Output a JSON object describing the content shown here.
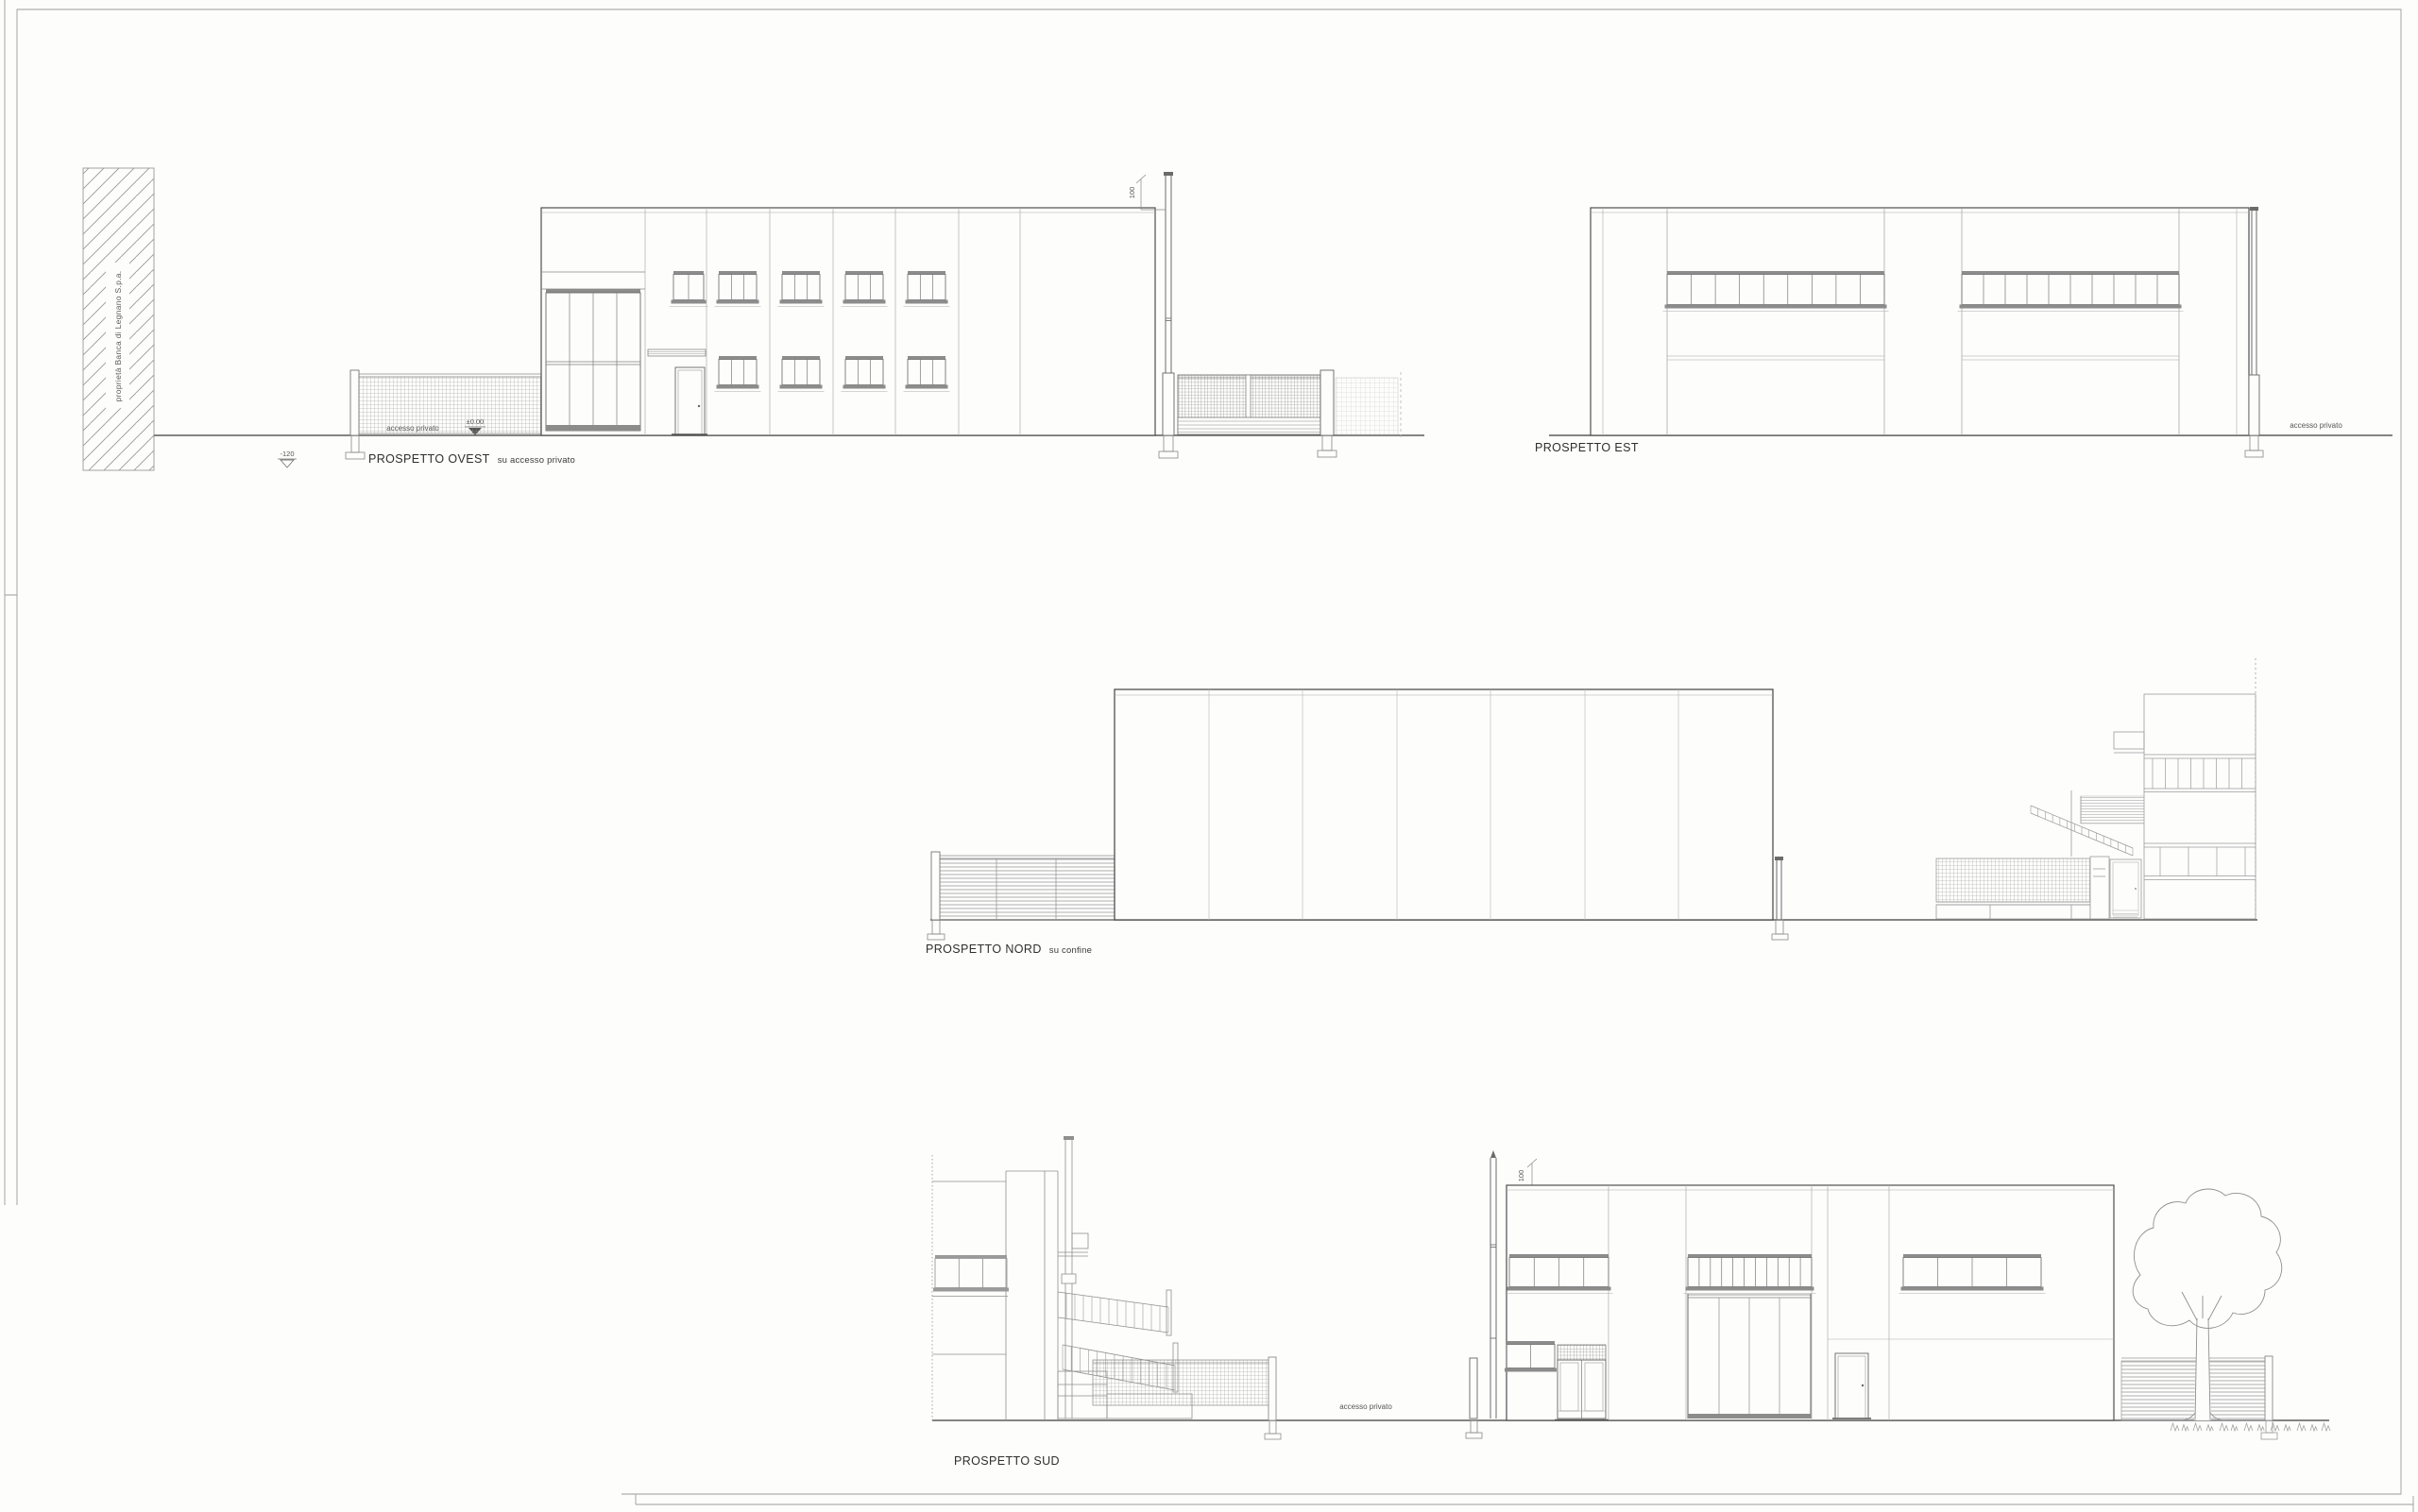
{
  "sheet": {
    "background_color": "#fdfdfc",
    "ink_color": "#4a4a4a",
    "annotation_color": "#555555",
    "elevations": {
      "ovest": {
        "title": "PROSPETTO OVEST",
        "subtitle": "su accesso privato",
        "access_label": "accesso privato",
        "level_marker_zero": "±0.00",
        "level_marker_low": "-120",
        "pole_dimension": "100",
        "neighbor_property_label": "proprietà Banca di Legnano S.p.a."
      },
      "est": {
        "title": "PROSPETTO EST",
        "access_label": "accesso privato"
      },
      "nord": {
        "title": "PROSPETTO NORD",
        "subtitle": "su confine"
      },
      "sud": {
        "title": "PROSPETTO SUD",
        "access_label": "accesso privato",
        "pole_dimension": "100"
      }
    }
  }
}
